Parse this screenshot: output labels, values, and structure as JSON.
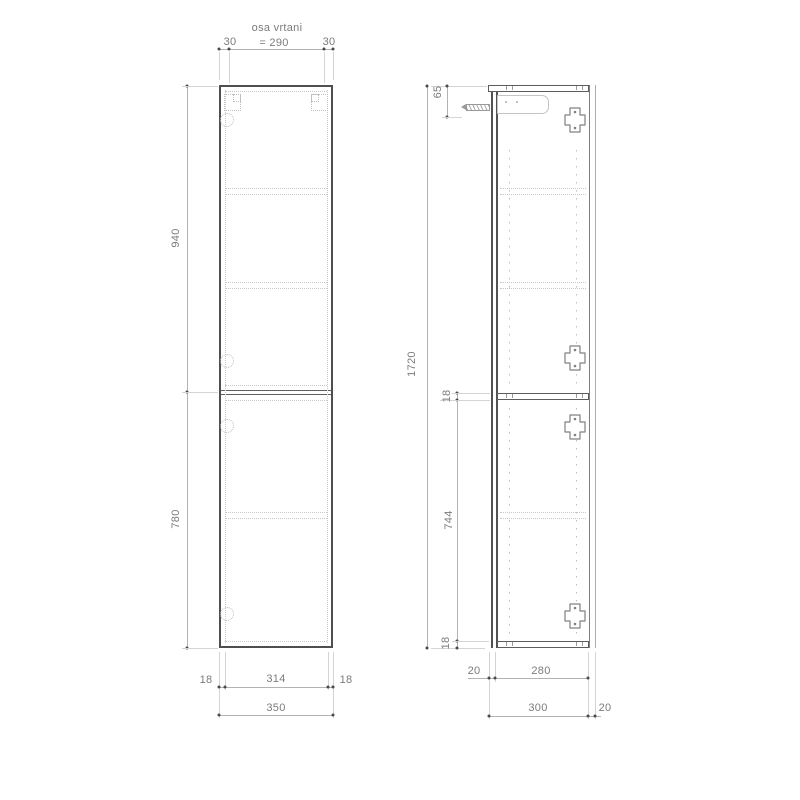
{
  "front_view": {
    "drill_axis_label": "osa vrtani",
    "drill_axis_spacing": "= 290",
    "edge_to_axis_left": "30",
    "edge_to_axis_right": "30",
    "upper_door_height": "940",
    "lower_door_height": "780",
    "bottom_row1": {
      "left": "18",
      "middle": "314",
      "right": "18"
    },
    "total_width": "350"
  },
  "side_view": {
    "total_height": "1720",
    "hanger_axis_offset": "65",
    "shelf_thickness": "18",
    "lower_section_height": "744",
    "bottom_panel_thickness": "18",
    "bottom_row1": {
      "left": "20",
      "middle": "280"
    },
    "bottom_row2": {
      "left": "300",
      "right": "20"
    }
  },
  "colors": {
    "outline": "#4f4f4f",
    "secondary_line": "#7d7d7d",
    "dimension_line": "#b3b3b3",
    "extension_line": "#d4d4d4",
    "dotted_line": "#c8c8c8",
    "text": "#7b7b7b",
    "marker": "#4a4a4a",
    "background": "#ffffff"
  }
}
